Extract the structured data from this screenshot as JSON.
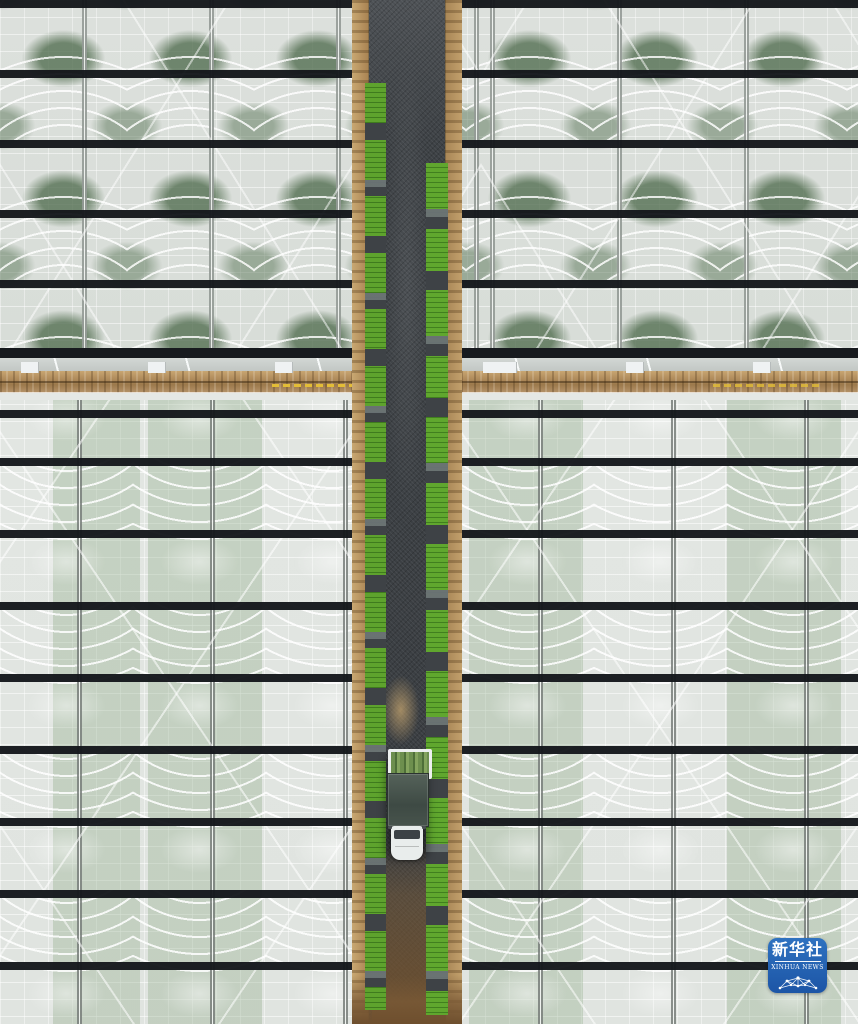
{
  "meta": {
    "description": "Aerial top-down photograph of large glass greenhouses separated by a central dark gravel road lined with green rice-seedling trays; a truck with a white cab is parked on the road; Xinhua News watermark in the lower right corner."
  },
  "watermark": {
    "brand_cn": "新华社",
    "brand_en": "XINHUA NEWS",
    "icon": "network-globe-icon",
    "bg_color": "#2365b5"
  },
  "palette": {
    "greenhouse_film": "#dde1dd",
    "purlin_bar_black": "#171a1e",
    "road_gravel": "#3e4246",
    "wood_edge": "#b08c5c",
    "seedling_tray_green": "#5ea32d",
    "truck_cargo": "#47534c",
    "truck_cab_white": "#e9edec",
    "dirt_tan": "#7b5a36"
  }
}
